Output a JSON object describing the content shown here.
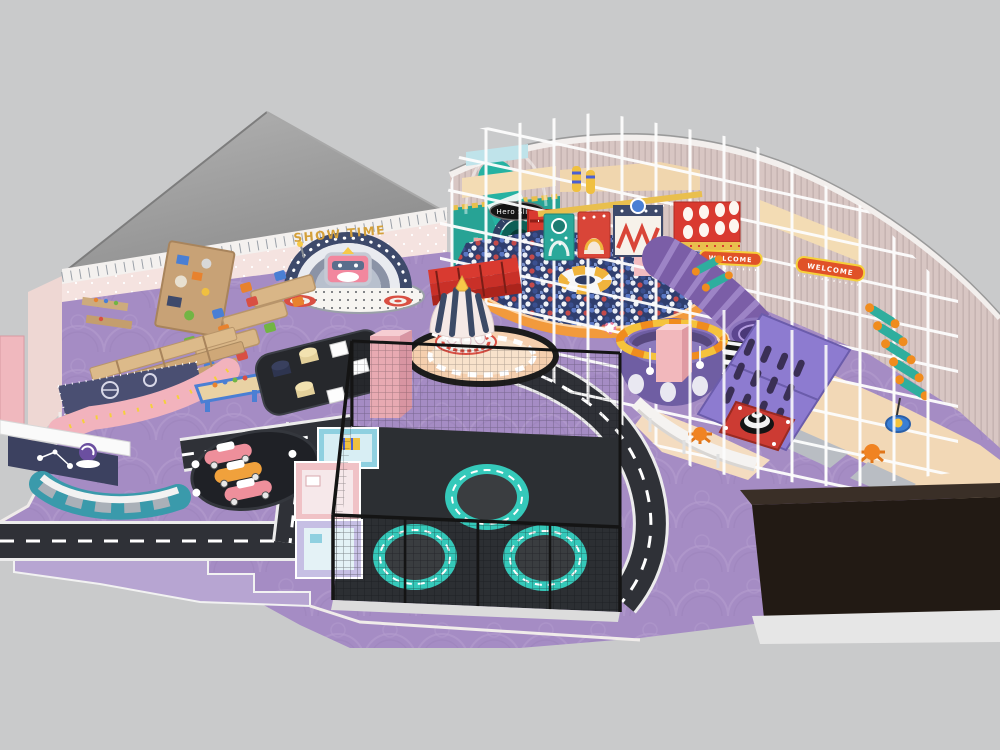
{
  "scene": {
    "type": "3d-render",
    "description": "Top-down 3D rendering of an indoor children's soft-play playground with ball pit, tube slide, trampoline park, carousel, toddler town, road mats and white climbing-frame cage",
    "background": "#c9cacb"
  },
  "labels": {
    "show_time": "SHOW TIME",
    "hero_slide": "Hero Slide",
    "welcome_upper": "WELCOME",
    "welcome_right": "WELCOME"
  },
  "palette": {
    "floor_purple": "#a58cc4",
    "floor_lavender": "#b7a5d2",
    "road_asphalt": "#2f3137",
    "wall_pink": "#f5e3e0",
    "curtain_wall": "#d8c6c3",
    "roof_gray": "#9e9e9e",
    "frame_white": "#fcfcfc",
    "ball_pit_navy": "#2f3e6e",
    "trampoline_teal": "#35c9ba",
    "slide_teal": "#25b2a2",
    "carousel_navy": "#3c4a66",
    "mat_peach": "#f5cfae",
    "accent_red": "#d93a30",
    "accent_orange": "#f08c1e",
    "roller_slide_purple": "#7b5ea7",
    "climb_board_violet": "#8d7bd0",
    "stage_dark": "#241b16"
  }
}
